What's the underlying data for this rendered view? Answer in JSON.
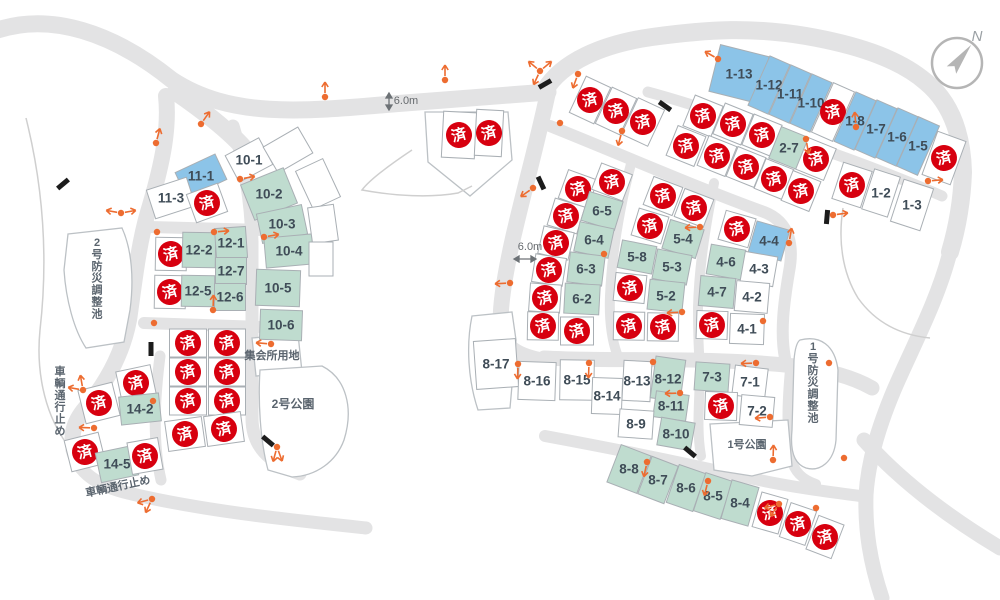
{
  "legend": {
    "sold_stamp": "済",
    "colors": {
      "sold_stamp_red": "#d7000f",
      "lot_blue": "#8cc4e8",
      "lot_green": "#bfdccf",
      "road_gray": "#e3e3e4",
      "label_text": "#3f4c57"
    }
  },
  "compass": {
    "north_label": "N"
  },
  "labels": [
    {
      "text": "6.0m",
      "x": 406,
      "y": 101,
      "size": 11,
      "cls": "dim-label",
      "name": "road-width-label"
    },
    {
      "text": "6.0m",
      "x": 530,
      "y": 247,
      "size": 11,
      "cls": "dim-label",
      "name": "road-width-label"
    },
    {
      "text": "集会所用地",
      "x": 272,
      "y": 356,
      "size": 11,
      "cls": "map-label",
      "name": "meeting-hall-site-label"
    },
    {
      "text": "2号公園",
      "x": 293,
      "y": 404,
      "size": 12,
      "cls": "map-label",
      "name": "park-2-label"
    },
    {
      "text": "1号公園",
      "x": 747,
      "y": 445,
      "size": 11,
      "cls": "map-label",
      "name": "park-1-label"
    },
    {
      "text": "2号防災調整池",
      "x": 97,
      "y": 243,
      "size": 11,
      "cls": "map-label",
      "vertical": true,
      "name": "pond-2-label"
    },
    {
      "text": "1号防災調整池",
      "x": 813,
      "y": 347,
      "size": 11,
      "cls": "map-label",
      "vertical": true,
      "name": "pond-1-label"
    },
    {
      "text": "車輌通行止め",
      "x": 60,
      "y": 372,
      "size": 11,
      "cls": "map-label",
      "vertical": true,
      "name": "road-closed-label"
    },
    {
      "text": "車輌通行止め",
      "x": 118,
      "y": 487,
      "size": 11,
      "cls": "map-label",
      "rot": -12,
      "name": "road-closed-label"
    }
  ],
  "lots": [
    {
      "label": "1-13",
      "x": 739,
      "y": 74,
      "w": 50,
      "h": 48,
      "r": 14,
      "s": "blue"
    },
    {
      "label": "1-12",
      "x": 769,
      "y": 85,
      "w": 22,
      "h": 54,
      "r": 24,
      "s": "blue"
    },
    {
      "label": "1-11",
      "x": 790,
      "y": 94,
      "w": 22,
      "h": 54,
      "r": 24,
      "s": "blue"
    },
    {
      "label": "1-10",
      "x": 811,
      "y": 103,
      "w": 22,
      "h": 54,
      "r": 24,
      "s": "blue"
    },
    {
      "x": 833,
      "y": 112,
      "w": 23,
      "h": 54,
      "r": 24,
      "s": "sold"
    },
    {
      "label": "1-8",
      "x": 855,
      "y": 121,
      "w": 22,
      "h": 54,
      "r": 24,
      "s": "blue"
    },
    {
      "label": "1-7",
      "x": 876,
      "y": 129,
      "w": 22,
      "h": 54,
      "r": 24,
      "s": "blue"
    },
    {
      "label": "1-6",
      "x": 897,
      "y": 137,
      "w": 22,
      "h": 54,
      "r": 24,
      "s": "blue"
    },
    {
      "label": "1-5",
      "x": 918,
      "y": 146,
      "w": 23,
      "h": 54,
      "r": 24,
      "s": "blue"
    },
    {
      "x": 944,
      "y": 158,
      "w": 30,
      "h": 46,
      "r": 20,
      "s": "sold"
    },
    {
      "x": 852,
      "y": 185,
      "w": 30,
      "h": 38,
      "r": 18,
      "s": "sold"
    },
    {
      "label": "1-2",
      "x": 881,
      "y": 193,
      "w": 27,
      "h": 42,
      "r": 18,
      "s": "white"
    },
    {
      "label": "1-3",
      "x": 912,
      "y": 205,
      "w": 31,
      "h": 44,
      "r": 18,
      "s": "white"
    },
    {
      "x": 703,
      "y": 116,
      "w": 30,
      "h": 33,
      "r": 22,
      "s": "sold"
    },
    {
      "x": 733,
      "y": 124,
      "w": 30,
      "h": 33,
      "r": 22,
      "s": "sold"
    },
    {
      "x": 762,
      "y": 135,
      "w": 30,
      "h": 33,
      "r": 22,
      "s": "sold"
    },
    {
      "label": "2-7",
      "x": 789,
      "y": 148,
      "w": 30,
      "h": 34,
      "r": 22,
      "s": "green"
    },
    {
      "x": 816,
      "y": 159,
      "w": 30,
      "h": 34,
      "r": 22,
      "s": "sold"
    },
    {
      "x": 686,
      "y": 146,
      "w": 30,
      "h": 32,
      "r": 22,
      "s": "sold"
    },
    {
      "x": 717,
      "y": 156,
      "w": 30,
      "h": 32,
      "r": 22,
      "s": "sold"
    },
    {
      "x": 746,
      "y": 167,
      "w": 30,
      "h": 32,
      "r": 22,
      "s": "sold"
    },
    {
      "x": 774,
      "y": 179,
      "w": 30,
      "h": 32,
      "r": 22,
      "s": "sold"
    },
    {
      "x": 801,
      "y": 191,
      "w": 30,
      "h": 32,
      "r": 22,
      "s": "sold"
    },
    {
      "x": 590,
      "y": 100,
      "w": 27,
      "h": 40,
      "r": 25,
      "s": "sold"
    },
    {
      "x": 616,
      "y": 111,
      "w": 27,
      "h": 40,
      "r": 25,
      "s": "sold"
    },
    {
      "x": 643,
      "y": 122,
      "w": 29,
      "h": 40,
      "r": 25,
      "s": "sold"
    },
    {
      "x": 459,
      "y": 135,
      "w": 33,
      "h": 46,
      "r": 3,
      "s": "sold"
    },
    {
      "x": 489,
      "y": 133,
      "w": 27,
      "h": 46,
      "r": 3,
      "s": "sold"
    },
    {
      "x": 578,
      "y": 189,
      "w": 31,
      "h": 30,
      "r": 20,
      "s": "sold"
    },
    {
      "x": 566,
      "y": 216,
      "w": 31,
      "h": 28,
      "r": 17,
      "s": "sold"
    },
    {
      "x": 556,
      "y": 243,
      "w": 31,
      "h": 28,
      "r": 13,
      "s": "sold"
    },
    {
      "x": 549,
      "y": 270,
      "w": 31,
      "h": 28,
      "r": 9,
      "s": "sold"
    },
    {
      "x": 545,
      "y": 298,
      "w": 31,
      "h": 28,
      "r": 4,
      "s": "sold"
    },
    {
      "x": 543,
      "y": 326,
      "w": 31,
      "h": 28,
      "r": 1,
      "s": "sold"
    },
    {
      "x": 612,
      "y": 182,
      "w": 33,
      "h": 28,
      "r": 21,
      "s": "sold"
    },
    {
      "label": "6-5",
      "x": 602,
      "y": 211,
      "w": 35,
      "h": 30,
      "r": 17,
      "s": "green"
    },
    {
      "label": "6-4",
      "x": 594,
      "y": 240,
      "w": 35,
      "h": 30,
      "r": 12,
      "s": "green"
    },
    {
      "label": "6-3",
      "x": 586,
      "y": 269,
      "w": 35,
      "h": 30,
      "r": 7,
      "s": "green"
    },
    {
      "label": "6-2",
      "x": 582,
      "y": 299,
      "w": 35,
      "h": 30,
      "r": 3,
      "s": "green"
    },
    {
      "x": 577,
      "y": 331,
      "w": 33,
      "h": 28,
      "r": 0,
      "s": "sold"
    },
    {
      "x": 663,
      "y": 196,
      "w": 31,
      "h": 30,
      "r": 21,
      "s": "sold"
    },
    {
      "x": 694,
      "y": 208,
      "w": 31,
      "h": 30,
      "r": 21,
      "s": "sold"
    },
    {
      "x": 650,
      "y": 226,
      "w": 31,
      "h": 28,
      "r": 17,
      "s": "sold"
    },
    {
      "label": "5-4",
      "x": 683,
      "y": 239,
      "w": 35,
      "h": 30,
      "r": 17,
      "s": "green"
    },
    {
      "label": "5-8",
      "x": 637,
      "y": 257,
      "w": 35,
      "h": 28,
      "r": 11,
      "s": "green"
    },
    {
      "label": "5-3",
      "x": 672,
      "y": 267,
      "w": 35,
      "h": 30,
      "r": 11,
      "s": "green"
    },
    {
      "x": 630,
      "y": 288,
      "w": 31,
      "h": 28,
      "r": 6,
      "s": "sold"
    },
    {
      "label": "5-2",
      "x": 666,
      "y": 296,
      "w": 35,
      "h": 30,
      "r": 6,
      "s": "green"
    },
    {
      "x": 629,
      "y": 326,
      "w": 31,
      "h": 28,
      "r": 1,
      "s": "sold"
    },
    {
      "x": 663,
      "y": 327,
      "w": 31,
      "h": 28,
      "r": 1,
      "s": "sold"
    },
    {
      "x": 737,
      "y": 229,
      "w": 31,
      "h": 30,
      "r": 16,
      "s": "sold"
    },
    {
      "label": "4-4",
      "x": 769,
      "y": 241,
      "w": 34,
      "h": 32,
      "r": 16,
      "s": "blue"
    },
    {
      "label": "4-6",
      "x": 726,
      "y": 262,
      "w": 35,
      "h": 30,
      "r": 10,
      "s": "green"
    },
    {
      "label": "4-3",
      "x": 759,
      "y": 269,
      "w": 33,
      "h": 30,
      "r": 10,
      "s": "white"
    },
    {
      "label": "4-7",
      "x": 717,
      "y": 292,
      "w": 35,
      "h": 30,
      "r": 5,
      "s": "green"
    },
    {
      "label": "4-2",
      "x": 752,
      "y": 297,
      "w": 33,
      "h": 30,
      "r": 5,
      "s": "white"
    },
    {
      "x": 712,
      "y": 325,
      "w": 31,
      "h": 28,
      "r": 2,
      "s": "sold"
    },
    {
      "label": "4-1",
      "x": 747,
      "y": 329,
      "w": 34,
      "h": 30,
      "r": 2,
      "s": "white"
    },
    {
      "label": "7-3",
      "x": 712,
      "y": 377,
      "w": 34,
      "h": 28,
      "r": 4,
      "s": "green"
    },
    {
      "label": "7-1",
      "x": 750,
      "y": 382,
      "w": 33,
      "h": 30,
      "r": 7,
      "s": "white"
    },
    {
      "x": 721,
      "y": 406,
      "w": 32,
      "h": 28,
      "r": 2,
      "s": "sold"
    },
    {
      "label": "7-2",
      "x": 757,
      "y": 411,
      "w": 33,
      "h": 30,
      "r": 5,
      "s": "white"
    },
    {
      "label": "8-17",
      "x": 496,
      "y": 364,
      "w": 42,
      "h": 48,
      "r": -4,
      "s": "white"
    },
    {
      "label": "8-16",
      "x": 537,
      "y": 381,
      "w": 37,
      "h": 38,
      "r": 2,
      "s": "white"
    },
    {
      "label": "8-15",
      "x": 577,
      "y": 380,
      "w": 34,
      "h": 40,
      "r": 1,
      "s": "white"
    },
    {
      "label": "8-14",
      "x": 607,
      "y": 396,
      "w": 30,
      "h": 36,
      "r": 2,
      "s": "white"
    },
    {
      "label": "8-13",
      "x": 637,
      "y": 381,
      "w": 28,
      "h": 40,
      "r": 3,
      "s": "white"
    },
    {
      "label": "8-12",
      "x": 668,
      "y": 379,
      "w": 30,
      "h": 42,
      "r": 8,
      "s": "green"
    },
    {
      "label": "8-11",
      "x": 671,
      "y": 406,
      "w": 33,
      "h": 26,
      "r": 8,
      "s": "green"
    },
    {
      "label": "8-9",
      "x": 636,
      "y": 424,
      "w": 34,
      "h": 28,
      "r": 4,
      "s": "white"
    },
    {
      "label": "8-10",
      "x": 676,
      "y": 434,
      "w": 34,
      "h": 28,
      "r": 10,
      "s": "green"
    },
    {
      "label": "8-8",
      "x": 629,
      "y": 469,
      "w": 32,
      "h": 40,
      "r": 21,
      "s": "green"
    },
    {
      "label": "8-7",
      "x": 658,
      "y": 480,
      "w": 28,
      "h": 40,
      "r": 21,
      "s": "green"
    },
    {
      "label": "8-6",
      "x": 686,
      "y": 488,
      "w": 28,
      "h": 40,
      "r": 19,
      "s": "green"
    },
    {
      "label": "8-5",
      "x": 713,
      "y": 496,
      "w": 28,
      "h": 40,
      "r": 18,
      "s": "green"
    },
    {
      "label": "8-4",
      "x": 740,
      "y": 503,
      "w": 28,
      "h": 40,
      "r": 16,
      "s": "green"
    },
    {
      "x": 770,
      "y": 513,
      "w": 27,
      "h": 36,
      "r": 16,
      "s": "sold"
    },
    {
      "x": 798,
      "y": 524,
      "w": 27,
      "h": 36,
      "r": 19,
      "s": "sold"
    },
    {
      "x": 825,
      "y": 537,
      "w": 27,
      "h": 36,
      "r": 21,
      "s": "sold"
    },
    {
      "x": 188,
      "y": 343,
      "w": 37,
      "h": 28,
      "r": 0,
      "s": "sold"
    },
    {
      "x": 227,
      "y": 343,
      "w": 37,
      "h": 28,
      "r": 0,
      "s": "sold"
    },
    {
      "x": 188,
      "y": 372,
      "w": 37,
      "h": 28,
      "r": 0,
      "s": "sold"
    },
    {
      "x": 227,
      "y": 372,
      "w": 37,
      "h": 28,
      "r": 0,
      "s": "sold"
    },
    {
      "x": 188,
      "y": 401,
      "w": 37,
      "h": 28,
      "r": 0,
      "s": "sold"
    },
    {
      "x": 227,
      "y": 401,
      "w": 37,
      "h": 28,
      "r": 0,
      "s": "sold"
    },
    {
      "x": 185,
      "y": 434,
      "w": 37,
      "h": 30,
      "r": -8,
      "s": "sold"
    },
    {
      "x": 224,
      "y": 429,
      "w": 37,
      "h": 30,
      "r": -8,
      "s": "sold"
    },
    {
      "x": 136,
      "y": 383,
      "w": 35,
      "h": 30,
      "r": -12,
      "s": "sold"
    },
    {
      "x": 99,
      "y": 403,
      "w": 35,
      "h": 34,
      "r": -14,
      "s": "sold"
    },
    {
      "label": "14-2",
      "x": 140,
      "y": 409,
      "w": 40,
      "h": 28,
      "r": -6,
      "s": "green"
    },
    {
      "x": 85,
      "y": 452,
      "w": 35,
      "h": 32,
      "r": -14,
      "s": "sold"
    },
    {
      "label": "14-5",
      "x": 117,
      "y": 464,
      "w": 38,
      "h": 30,
      "r": -12,
      "s": "green"
    },
    {
      "x": 145,
      "y": 456,
      "w": 31,
      "h": 32,
      "r": -10,
      "s": "sold"
    },
    {
      "label": "11-1",
      "x": 201,
      "y": 176,
      "w": 44,
      "h": 28,
      "r": -25,
      "s": "blue"
    },
    {
      "label": "11-3",
      "x": 171,
      "y": 198,
      "w": 42,
      "h": 30,
      "r": -18,
      "s": "white"
    },
    {
      "x": 207,
      "y": 203,
      "w": 33,
      "h": 30,
      "r": -20,
      "s": "sold"
    },
    {
      "x": 171,
      "y": 254,
      "w": 31,
      "h": 33,
      "r": 1,
      "s": "sold"
    },
    {
      "x": 170,
      "y": 292,
      "w": 31,
      "h": 33,
      "r": 1,
      "s": "sold"
    },
    {
      "label": "12-2",
      "x": 199,
      "y": 250,
      "w": 33,
      "h": 35,
      "r": 1,
      "s": "green"
    },
    {
      "label": "12-1",
      "x": 231,
      "y": 243,
      "w": 31,
      "h": 31,
      "r": -4,
      "s": "green"
    },
    {
      "label": "12-7",
      "x": 231,
      "y": 271,
      "w": 31,
      "h": 27,
      "r": 0,
      "s": "green"
    },
    {
      "label": "12-5",
      "x": 198,
      "y": 291,
      "w": 33,
      "h": 31,
      "r": 1,
      "s": "green"
    },
    {
      "label": "12-6",
      "x": 230,
      "y": 297,
      "w": 31,
      "h": 27,
      "r": 0,
      "s": "green"
    },
    {
      "label": "10-1",
      "x": 249,
      "y": 160,
      "w": 38,
      "h": 30,
      "r": -28,
      "s": "white"
    },
    {
      "x": 288,
      "y": 150,
      "w": 40,
      "h": 30,
      "r": -30,
      "s": "plain"
    },
    {
      "label": "10-2",
      "x": 269,
      "y": 194,
      "w": 46,
      "h": 38,
      "r": -22,
      "s": "green"
    },
    {
      "label": "10-3",
      "x": 282,
      "y": 224,
      "w": 46,
      "h": 30,
      "r": -12,
      "s": "green"
    },
    {
      "label": "10-4",
      "x": 289,
      "y": 251,
      "w": 48,
      "h": 30,
      "r": -5,
      "s": "green"
    },
    {
      "label": "10-5",
      "x": 278,
      "y": 288,
      "w": 44,
      "h": 36,
      "r": 2,
      "s": "green"
    },
    {
      "label": "10-6",
      "x": 281,
      "y": 325,
      "w": 42,
      "h": 30,
      "r": 2,
      "s": "green"
    },
    {
      "x": 318,
      "y": 184,
      "w": 30,
      "h": 42,
      "r": -25,
      "s": "plain"
    },
    {
      "x": 323,
      "y": 224,
      "w": 26,
      "h": 36,
      "r": -8,
      "s": "plain"
    },
    {
      "x": 321,
      "y": 259,
      "w": 24,
      "h": 34,
      "r": 0,
      "s": "plain"
    }
  ],
  "markers": [
    {
      "x": 325,
      "y": 97,
      "a": [
        90
      ]
    },
    {
      "x": 445,
      "y": 80,
      "a": [
        90
      ]
    },
    {
      "x": 540,
      "y": 71,
      "a": [
        40,
        140,
        245
      ]
    },
    {
      "x": 578,
      "y": 74,
      "a": [
        250
      ]
    },
    {
      "x": 560,
      "y": 123,
      "a": []
    },
    {
      "x": 533,
      "y": 188,
      "a": [
        215
      ]
    },
    {
      "x": 718,
      "y": 59,
      "a": [
        150
      ]
    },
    {
      "x": 806,
      "y": 139,
      "a": [
        280
      ]
    },
    {
      "x": 856,
      "y": 127,
      "a": [
        95
      ]
    },
    {
      "x": 928,
      "y": 181,
      "a": [
        5
      ]
    },
    {
      "x": 622,
      "y": 131,
      "a": [
        255
      ]
    },
    {
      "x": 201,
      "y": 124,
      "a": [
        55
      ]
    },
    {
      "x": 156,
      "y": 143,
      "a": [
        75
      ]
    },
    {
      "x": 121,
      "y": 213,
      "a": [
        170,
        10
      ]
    },
    {
      "x": 157,
      "y": 232,
      "a": []
    },
    {
      "x": 240,
      "y": 179,
      "a": [
        10
      ]
    },
    {
      "x": 214,
      "y": 232,
      "a": [
        5
      ]
    },
    {
      "x": 264,
      "y": 237,
      "a": [
        10
      ]
    },
    {
      "x": 213,
      "y": 310,
      "a": [
        88
      ]
    },
    {
      "x": 154,
      "y": 323,
      "a": []
    },
    {
      "x": 83,
      "y": 390,
      "a": [
        100,
        170
      ]
    },
    {
      "x": 94,
      "y": 428,
      "a": [
        178
      ]
    },
    {
      "x": 153,
      "y": 401,
      "a": []
    },
    {
      "x": 271,
      "y": 344,
      "a": [
        175
      ]
    },
    {
      "x": 277,
      "y": 447,
      "a": [
        255,
        290
      ]
    },
    {
      "x": 152,
      "y": 499,
      "a": [
        195,
        245
      ]
    },
    {
      "x": 518,
      "y": 364,
      "a": [
        268
      ]
    },
    {
      "x": 589,
      "y": 363,
      "a": [
        268
      ]
    },
    {
      "x": 653,
      "y": 362,
      "a": []
    },
    {
      "x": 680,
      "y": 393,
      "a": [
        182
      ]
    },
    {
      "x": 756,
      "y": 363,
      "a": [
        182
      ]
    },
    {
      "x": 770,
      "y": 417,
      "a": [
        185
      ]
    },
    {
      "x": 773,
      "y": 460,
      "a": [
        88
      ]
    },
    {
      "x": 647,
      "y": 462,
      "a": [
        258
      ]
    },
    {
      "x": 708,
      "y": 481,
      "a": [
        256
      ]
    },
    {
      "x": 829,
      "y": 363,
      "a": []
    },
    {
      "x": 844,
      "y": 458,
      "a": []
    },
    {
      "x": 779,
      "y": 504,
      "a": [
        195,
        235
      ]
    },
    {
      "x": 816,
      "y": 508,
      "a": []
    },
    {
      "x": 604,
      "y": 254,
      "a": []
    },
    {
      "x": 700,
      "y": 227,
      "a": [
        183
      ]
    },
    {
      "x": 682,
      "y": 312,
      "a": [
        184
      ]
    },
    {
      "x": 789,
      "y": 243,
      "a": [
        80
      ]
    },
    {
      "x": 510,
      "y": 283,
      "a": [
        183
      ]
    },
    {
      "x": 833,
      "y": 215,
      "a": [
        8
      ]
    },
    {
      "x": 763,
      "y": 321,
      "a": []
    }
  ],
  "bars": [
    {
      "x": 63,
      "y": 184,
      "r": -40
    },
    {
      "x": 151,
      "y": 349,
      "r": 90
    },
    {
      "x": 268,
      "y": 441,
      "r": 40
    },
    {
      "x": 545,
      "y": 84,
      "r": -30
    },
    {
      "x": 665,
      "y": 106,
      "r": 35
    },
    {
      "x": 541,
      "y": 183,
      "r": 65
    },
    {
      "x": 690,
      "y": 452,
      "r": 40
    },
    {
      "x": 827,
      "y": 217,
      "r": 95
    }
  ]
}
